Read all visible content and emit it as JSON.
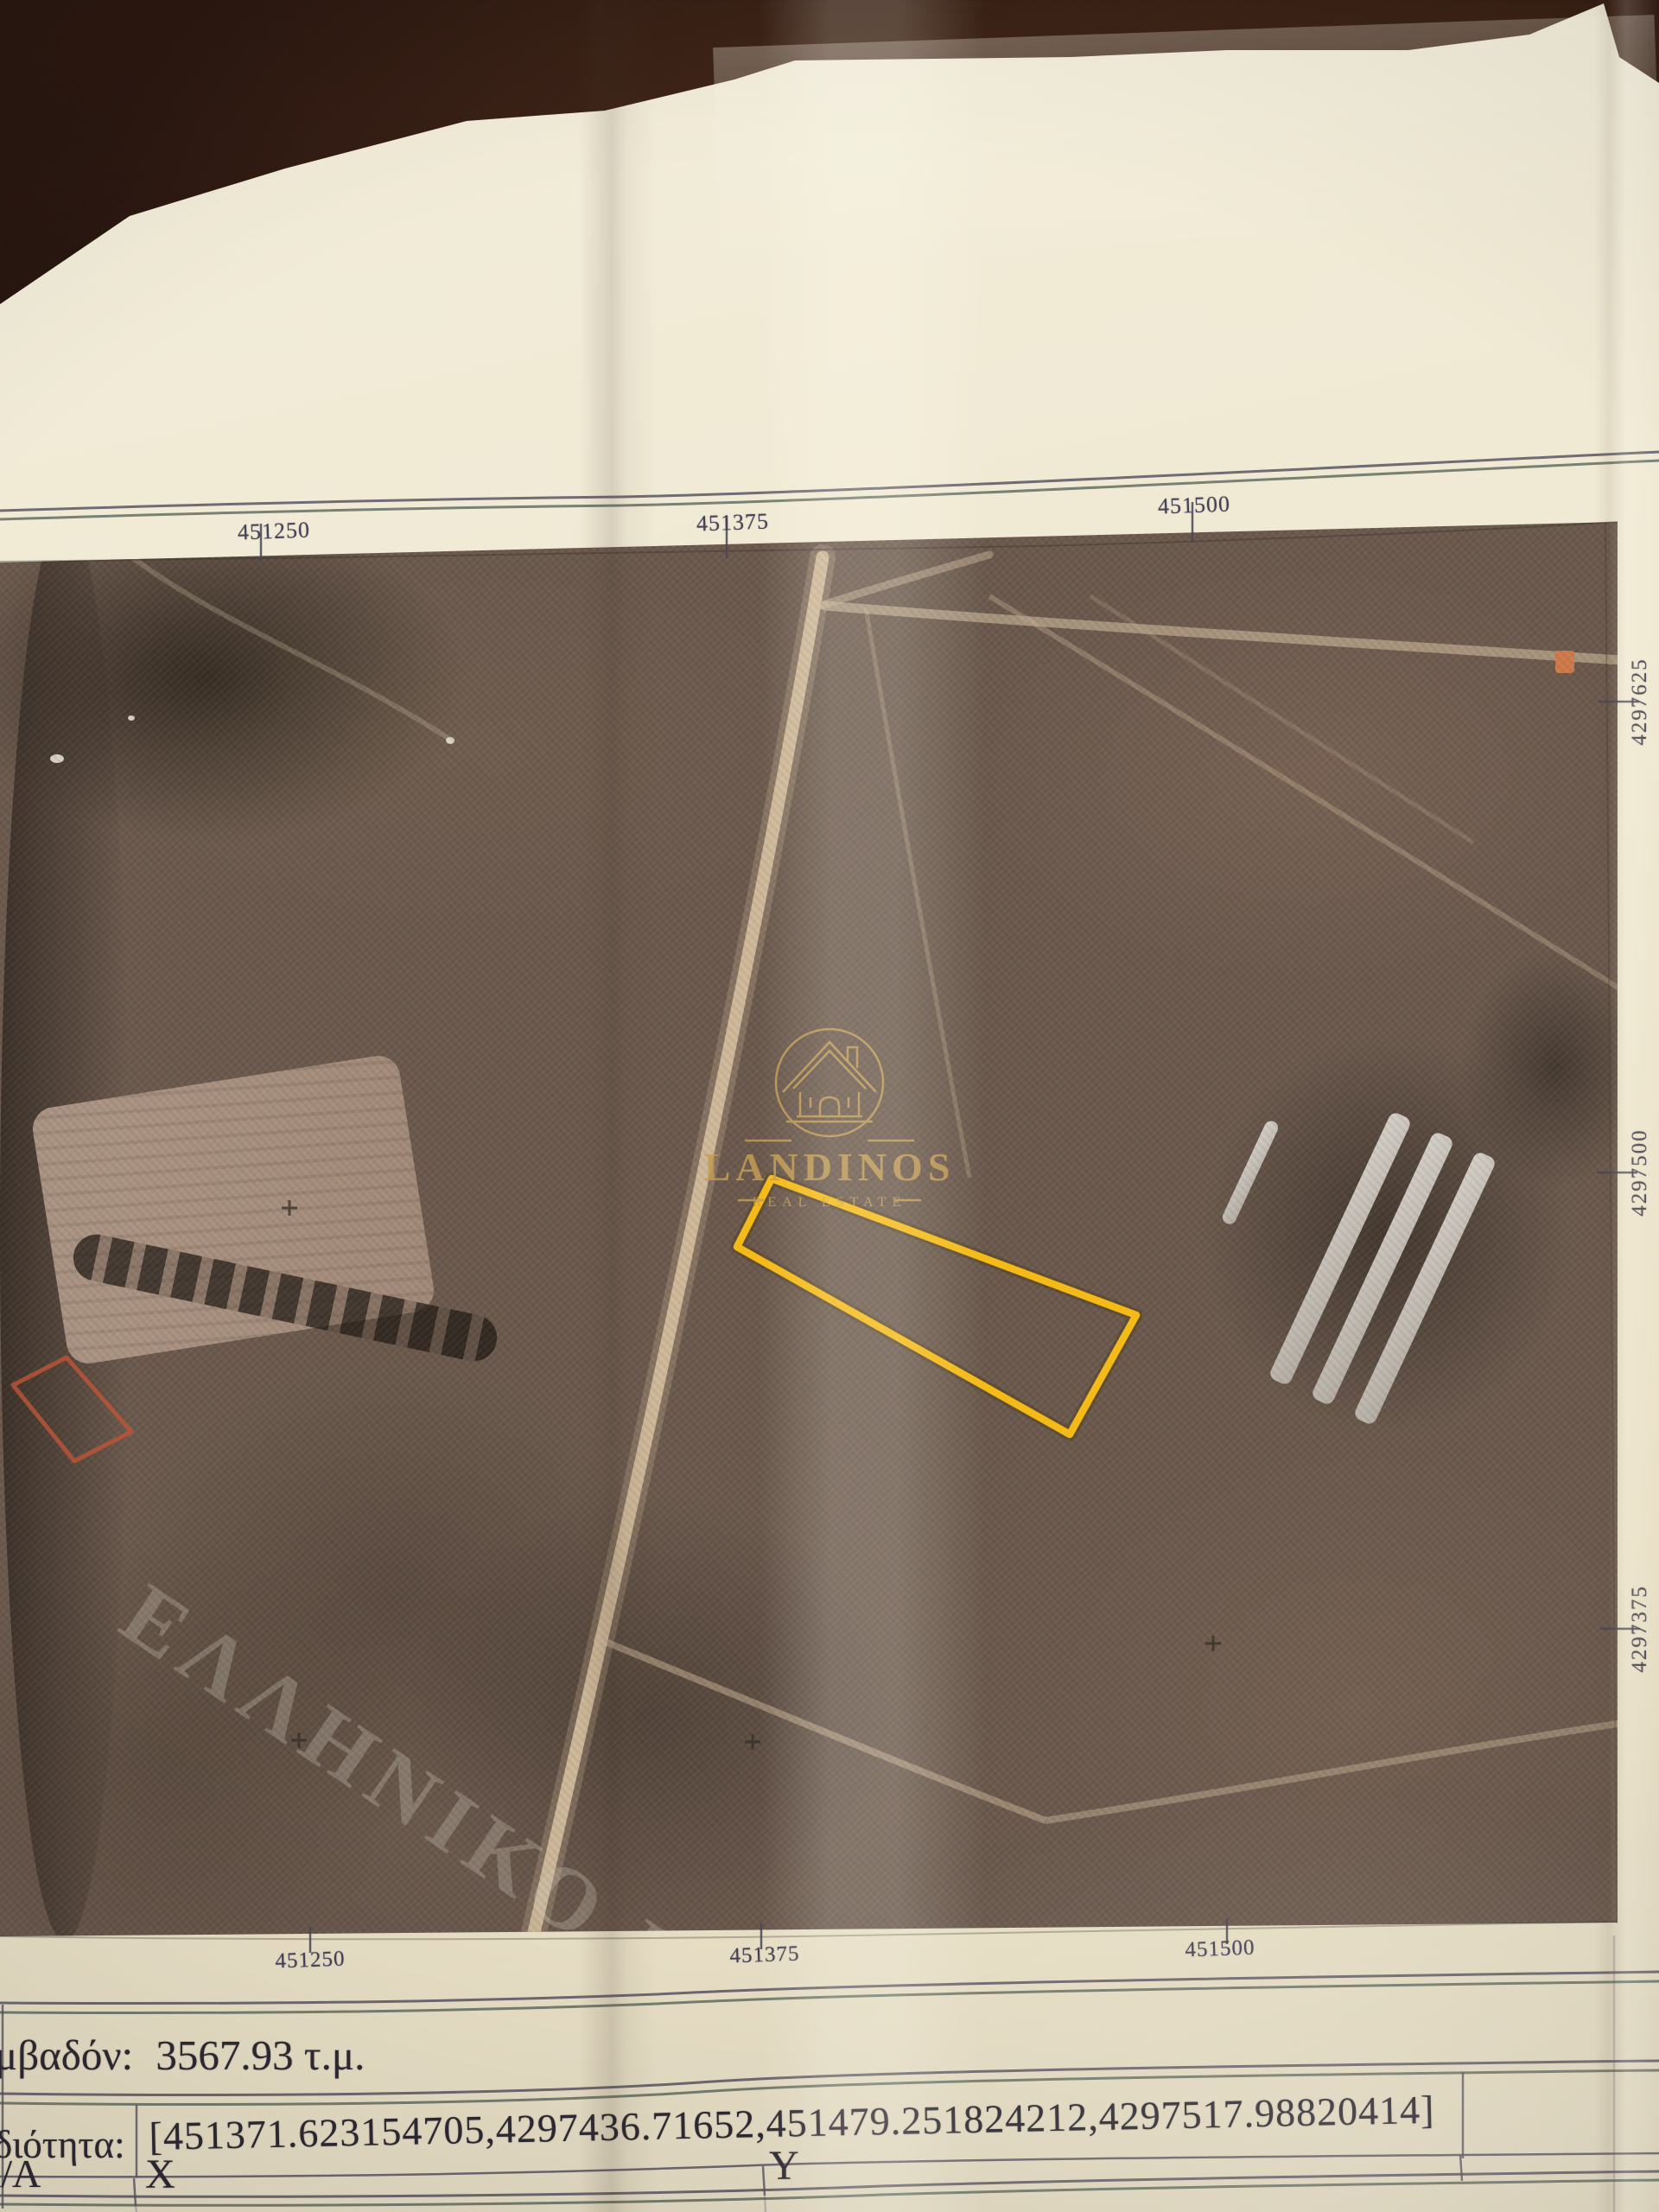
{
  "map": {
    "top_labels": [
      "451250",
      "451375",
      "451500"
    ],
    "bottom_labels": [
      "451250",
      "451375",
      "451500"
    ],
    "right_labels": [
      "4297625",
      "4297500",
      "4297375"
    ],
    "cadastre_watermark": "ΕΛΛΗΝΙΚΟ ΚΤΗΜ"
  },
  "logo": {
    "name": "LANDINOS",
    "subtitle": "REAL ESTATE"
  },
  "table": {
    "area_label": "Εμβαδόν:",
    "area_value": "3567.93 τ.μ.",
    "property_label": "Ιδιότητα:",
    "property_value": "[451371.623154705,4297436.71652,451479.251824212,4297517.98820414]",
    "columns": {
      "aa": "Α/Α",
      "x": "X",
      "y": "Y"
    }
  },
  "colors": {
    "parcel_outline": "#f4ba17",
    "logo_gold": "#c49c54",
    "marker_red": "#bf5537",
    "marker_orange": "#cf7a4a",
    "paper": "#f0e9d3"
  }
}
